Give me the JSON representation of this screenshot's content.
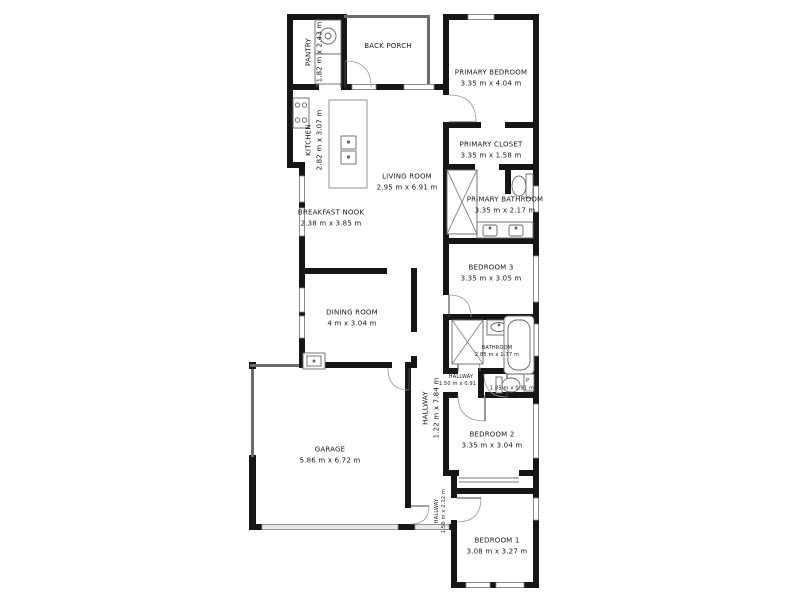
{
  "document_type": "floor-plan",
  "colors": {
    "wall": "#161616",
    "background": "#ffffff",
    "window_stroke": "#8a8a8a",
    "fixture_stroke": "#555555",
    "door_arc": "#999999"
  },
  "rooms": {
    "pantry": {
      "name": "PANTRY",
      "dims": "1.82 m x 2.43 m"
    },
    "back_porch": {
      "name": "BACK PORCH",
      "dims": ""
    },
    "primary_bedroom": {
      "name": "PRIMARY BEDROOM",
      "dims": "3.35 m x 4.04 m"
    },
    "kitchen": {
      "name": "KITCHEN",
      "dims": "2.82 m x 3.07 m"
    },
    "living_room": {
      "name": "LIVING ROOM",
      "dims": "2.95 m x 6.91 m"
    },
    "primary_closet": {
      "name": "PRIMARY CLOSET",
      "dims": "3.35 m x 1.58 m"
    },
    "primary_bathroom": {
      "name": "PRIMARY BATHROOM",
      "dims": "3.35 m x 2.17 m"
    },
    "breakfast_nook": {
      "name": "BREAKFAST NOOK",
      "dims": "2.38 m x 3.85 m"
    },
    "bedroom_3": {
      "name": "BEDROOM 3",
      "dims": "3.35 m x 3.05 m"
    },
    "dining_room": {
      "name": "DINING ROOM",
      "dims": "4 m x 3.04 m"
    },
    "bathroom": {
      "name": "BATHROOM",
      "dims": "2.85 m x 1.77 m"
    },
    "hallway_small": {
      "name": "HALLWAY",
      "dims": "1.50 m x 0.91 m"
    },
    "toilet_room": {
      "name": "",
      "dims": "1.85 m x 0.91 m"
    },
    "hallway_main": {
      "name": "HALLWAY",
      "dims": "1.22 m x 7.84 m"
    },
    "garage": {
      "name": "GARAGE",
      "dims": "5.86 m x 6.72 m"
    },
    "bedroom_2": {
      "name": "BEDROOM 2",
      "dims": "3.35 m x 3.04 m"
    },
    "hallway_lower": {
      "name": "HALLWAY",
      "dims": "1.50 m x 2.12 m"
    },
    "bedroom_1": {
      "name": "BEDROOM 1",
      "dims": "3.08 m x 3.27 m"
    }
  },
  "fixtures": {
    "p_label": "P",
    "icons": [
      "washer-icon",
      "stove-icon",
      "island-sink-icon",
      "shower-icon",
      "toilet-icon",
      "vanity-sink-icon",
      "bathtub-icon",
      "utility-sink-icon",
      "garage-door",
      "closet-sliders"
    ]
  }
}
